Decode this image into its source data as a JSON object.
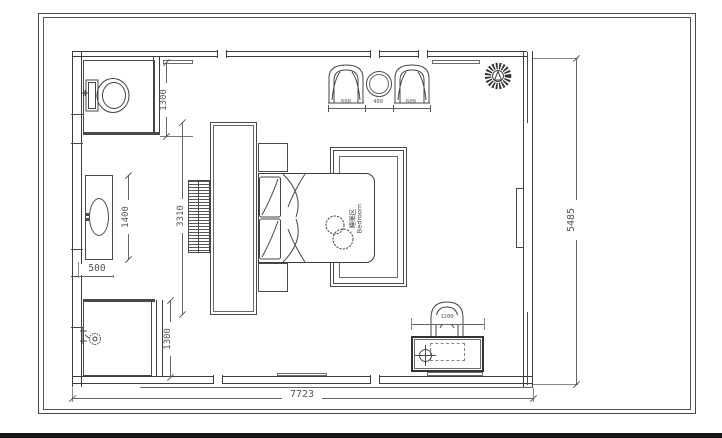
{
  "drawing_title": "bedroom-floor-plan",
  "room_label": {
    "zh": "睡眠区",
    "en": "Bedroom"
  },
  "dims": {
    "overall_width": "7723",
    "overall_height": "5485",
    "wc_depth": "1300",
    "shower_depth": "1300",
    "vanity_length": "1400",
    "vanity_depth": "500",
    "tv_wall_length": "3310",
    "armchair_left_width": "600",
    "side_table_width": "400",
    "armchair_right_width": "600",
    "dresser_width": "1200"
  }
}
